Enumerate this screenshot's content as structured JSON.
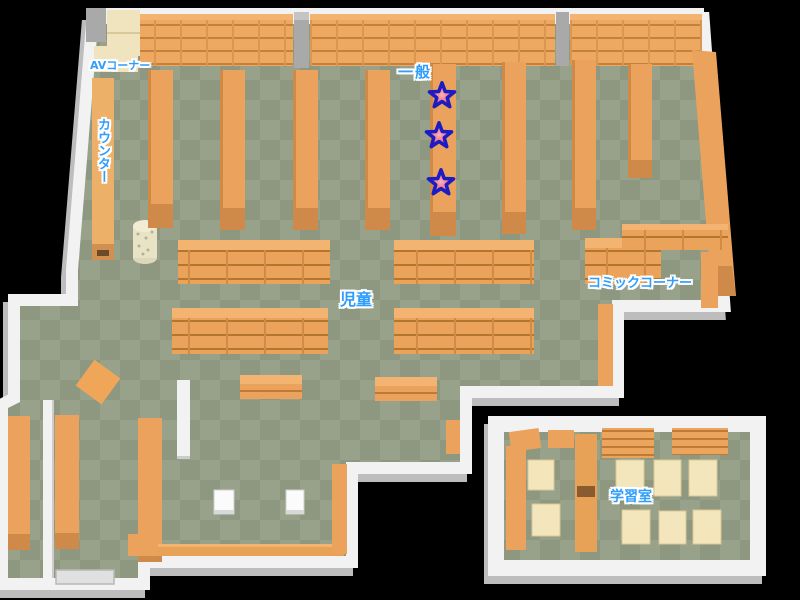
{
  "map": {
    "areas": [
      {
        "id": "av_corner",
        "label": "AVコーナー"
      },
      {
        "id": "counter",
        "label": "カウンター"
      },
      {
        "id": "general",
        "label": "一般"
      },
      {
        "id": "children",
        "label": "児童"
      },
      {
        "id": "comic_corner",
        "label": "コミックコーナー"
      },
      {
        "id": "study_room",
        "label": "学習室"
      }
    ],
    "markers": {
      "type": "star",
      "count": 3,
      "location": "general-area-bookshelf",
      "fill": "#ee6e82",
      "outline": "#1c1cc4"
    },
    "colors": {
      "background": "#000000",
      "floor_dark": "#8e9881",
      "floor_light": "#98a28a",
      "shelf_orange": "#eba25c",
      "shelf_line": "#bd7c3c",
      "cream_furniture": "#f4e6bc",
      "wall_white": "#f2f2f2",
      "wall_shadow": "#bdbdbd",
      "label_blue": "#2f9dfc"
    }
  }
}
